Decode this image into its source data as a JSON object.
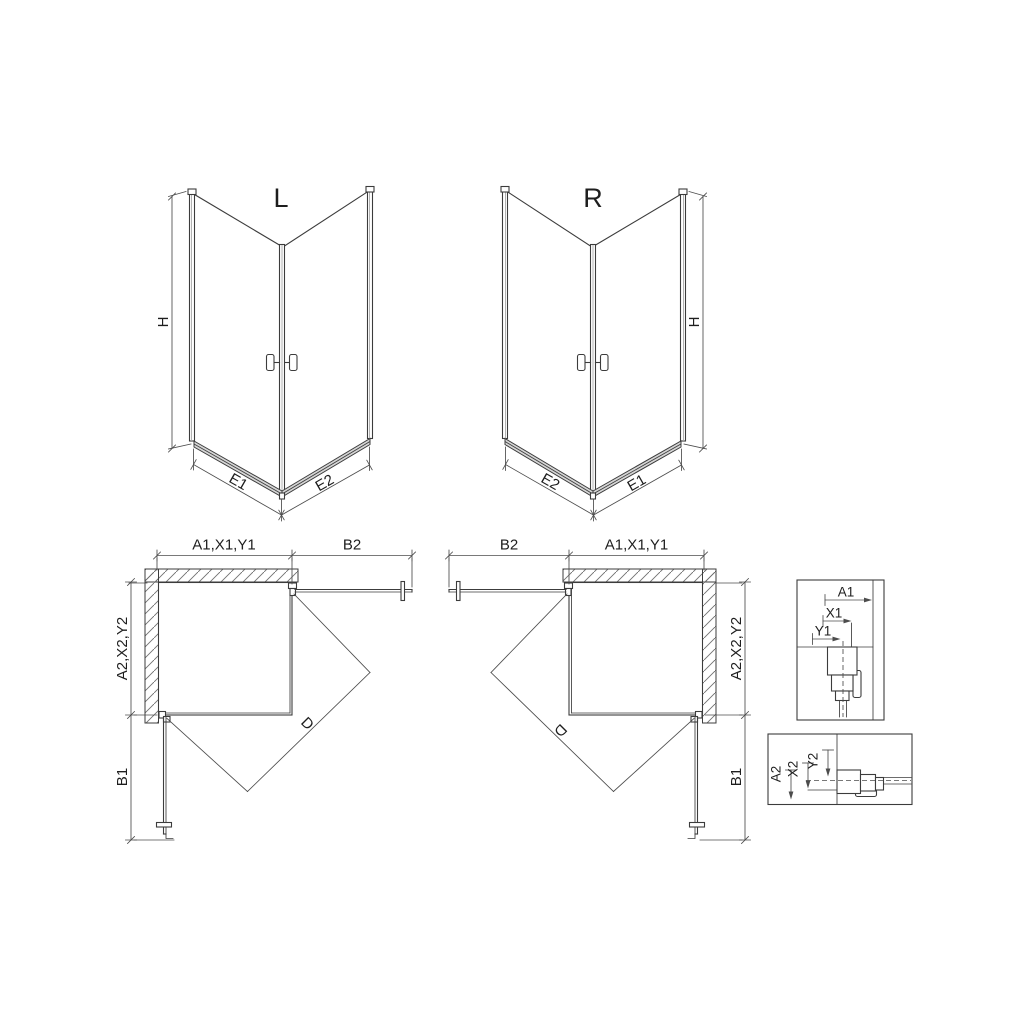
{
  "perspective_left": {
    "title": "L",
    "dim_height": "H",
    "dim_bottom_left": "E1",
    "dim_bottom_right": "E2"
  },
  "perspective_right": {
    "title": "R",
    "dim_height": "H",
    "dim_bottom_left": "E2",
    "dim_bottom_right": "E1"
  },
  "plan_left": {
    "dim_top_panel": "A1,X1,Y1",
    "dim_top_door": "B2",
    "dim_side_panel": "A2,X2,Y2",
    "dim_side_door": "B1",
    "dim_diagonal": "D"
  },
  "plan_right": {
    "dim_top_door": "B2",
    "dim_top_panel": "A1,X1,Y1",
    "dim_side_panel": "A2,X2,Y2",
    "dim_side_door": "B1",
    "dim_diagonal": "D"
  },
  "detail_top": {
    "dim_a": "A1",
    "dim_x": "X1",
    "dim_y": "Y1"
  },
  "detail_bottom": {
    "dim_a": "A2",
    "dim_x": "X2",
    "dim_y": "Y2"
  },
  "colors": {
    "line": "#3c3c3c",
    "dimension": "#4c4c4c",
    "hatch": "#6f6f6f",
    "background": "#ffffff"
  }
}
